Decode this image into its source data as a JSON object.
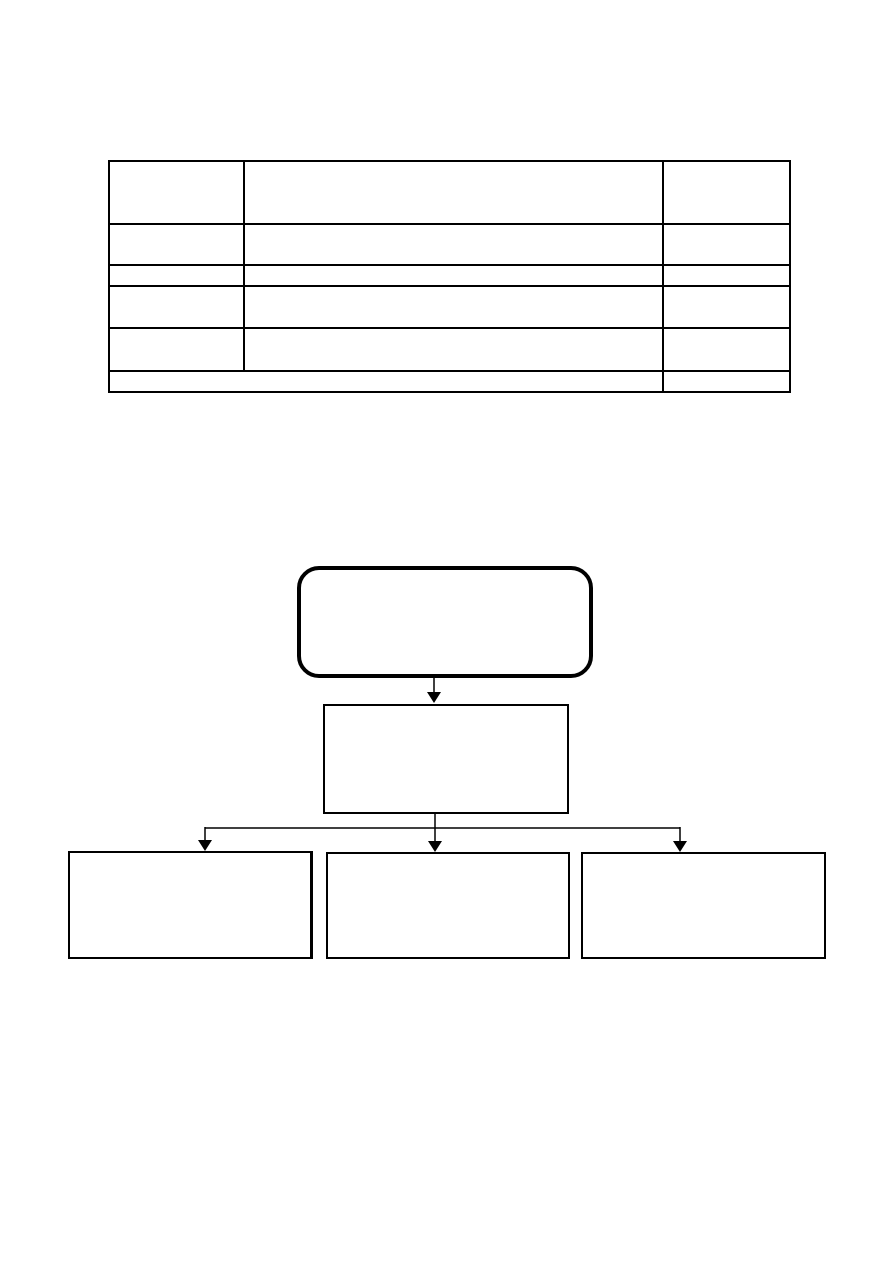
{
  "page": {
    "background_color": "#ffffff",
    "ink_color": "#000000",
    "kind": "blank document page with empty table and empty flowchart"
  },
  "table": {
    "columns": 3,
    "row_count": 6,
    "last_row_merges_first_two_columns": true,
    "rows": [
      {
        "cells": [
          "",
          "",
          ""
        ]
      },
      {
        "cells": [
          "",
          "",
          ""
        ]
      },
      {
        "cells": [
          "",
          "",
          ""
        ]
      },
      {
        "cells": [
          "",
          "",
          ""
        ]
      },
      {
        "cells": [
          "",
          "",
          ""
        ]
      },
      {
        "cells": [
          "",
          ""
        ]
      }
    ]
  },
  "flowchart": {
    "root_node": {
      "shape": "rounded-rectangle",
      "label": ""
    },
    "level2_node": {
      "shape": "rectangle",
      "label": ""
    },
    "child_nodes": [
      {
        "shape": "rectangle",
        "label": ""
      },
      {
        "shape": "rectangle",
        "label": ""
      },
      {
        "shape": "rectangle",
        "label": ""
      }
    ],
    "connector_style": {
      "line_color": "#000000",
      "arrowhead": "filled-triangle-down"
    }
  }
}
